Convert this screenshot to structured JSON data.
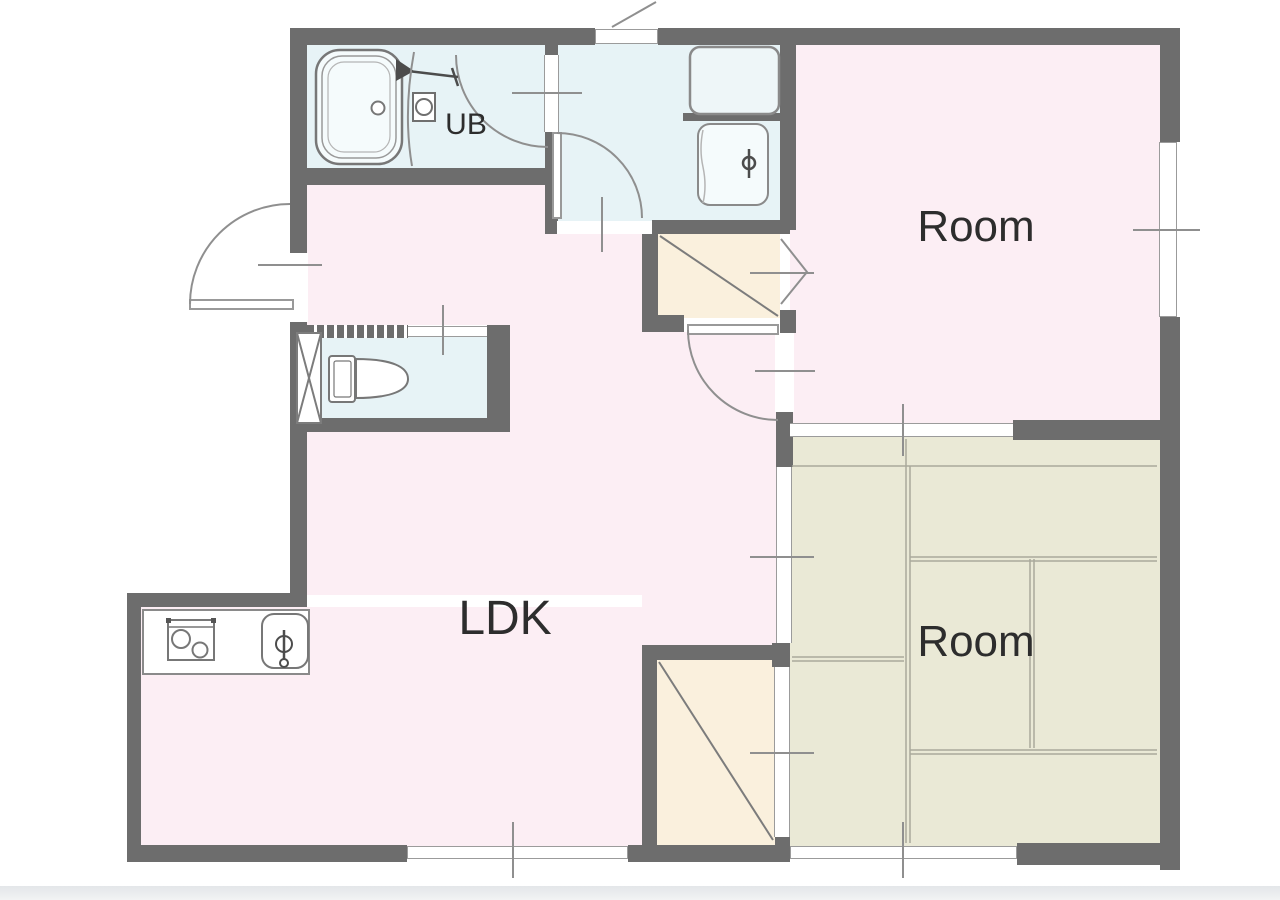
{
  "plan": {
    "labels": {
      "unit_bath": "UB",
      "room_top": "Room",
      "ldk": "LDK",
      "room_tatami": "Room"
    },
    "palette": {
      "wall_gray": "#6d6d6d",
      "room_pink": "#fceef4",
      "wet_area_blue": "#e7f3f6",
      "closet_beige": "#faf0dd",
      "tatami_green": "#eae9d6",
      "thin_line_gray": "#8f8f8f",
      "label_color": "#2d2d2d",
      "background": "#ffffff"
    },
    "fixtures": [
      "bathtub-icon",
      "shower-faucet-icon",
      "bath-control-icon",
      "washing-machine-pan-icon",
      "washbasin-icon",
      "toilet-icon",
      "pipe-shaft-icon",
      "stove-icon",
      "kitchen-sink-icon"
    ],
    "symbols": [
      "swing-door",
      "sliding-door",
      "folding-door",
      "window",
      "opening-center-tick",
      "closet-diagonal",
      "tatami-mats"
    ]
  }
}
